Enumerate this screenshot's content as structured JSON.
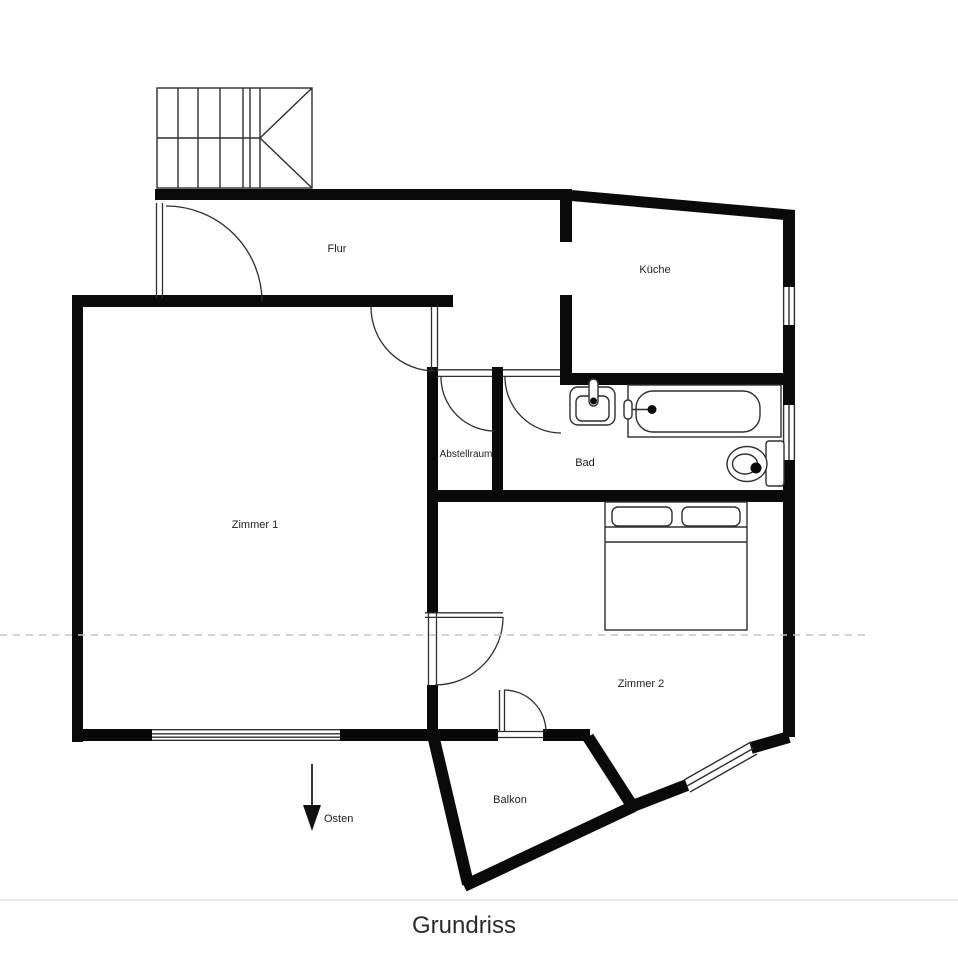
{
  "title": "Grundriss",
  "compass": {
    "direction_label": "Osten"
  },
  "rooms": {
    "flur": "Flur",
    "kueche": "Küche",
    "abstellraum": "Abstellraum",
    "bad": "Bad",
    "zimmer1": "Zimmer 1",
    "zimmer2": "Zimmer 2",
    "balkon": "Balkon"
  },
  "fixtures": {
    "stairs": "stairs-icon",
    "bathtub": "bathtub-icon",
    "sink": "sink-icon",
    "toilet": "toilet-icon",
    "bed": "double-bed-icon",
    "compass_arrow": "south-east-arrow-icon"
  },
  "colors": {
    "wall": "#0a0a0a",
    "line": "#2e2e2e",
    "dashed": "#c2c2c2",
    "text": "#1e1e1e",
    "separator": "#e4e4e4",
    "background": "#ffffff"
  }
}
